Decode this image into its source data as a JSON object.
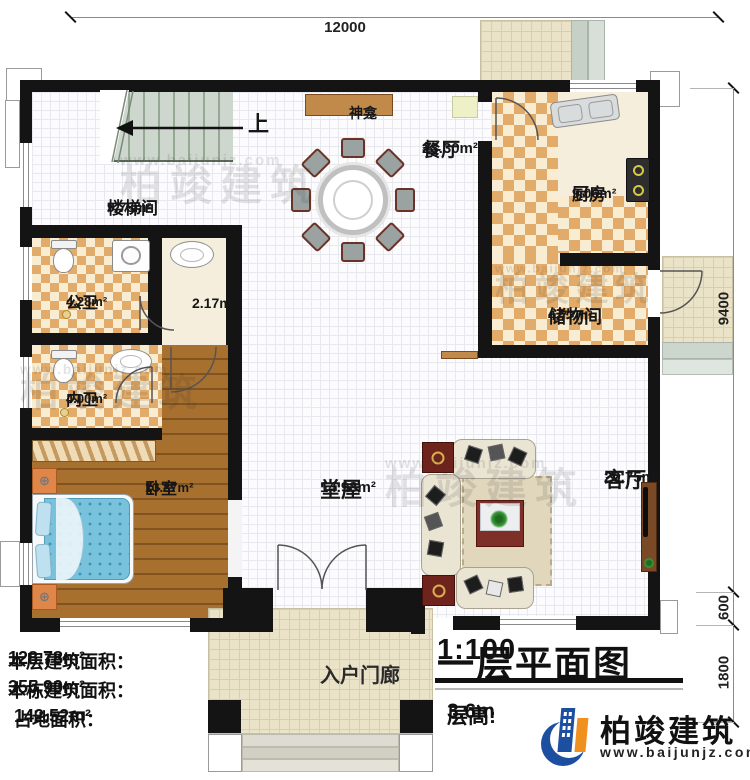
{
  "dimensions": {
    "width_top": "12000",
    "right_main": "9400",
    "right_step": "600",
    "right_porch": "1800"
  },
  "rooms": {
    "stairwell": {
      "name": "楼梯间",
      "area": "9.73m²"
    },
    "dining": {
      "name": "餐厅",
      "area": "23.30m²"
    },
    "kitchen": {
      "name": "厨房",
      "area": "9.06m²"
    },
    "storage": {
      "name": "储物间",
      "area": "4.77m²"
    },
    "public_bath": {
      "name": "公卫",
      "area": "4.28m²"
    },
    "washroom": {
      "area": "2.17m²"
    },
    "inner_bath": {
      "name": "内卫",
      "area": "4.00m²"
    },
    "bedroom": {
      "name": "卧室",
      "area": "13.87m²"
    },
    "hall": {
      "name": "堂屋",
      "area": "14.98m²"
    },
    "living": {
      "name": "客厅",
      "area": "20.75m²"
    },
    "entry_porch": {
      "name": "入户门廊"
    }
  },
  "markers": {
    "shrine": "神龛",
    "stairs_up": "上"
  },
  "stats": {
    "floor_area_label": "本层建筑面积：",
    "floor_area": "128.78m²",
    "building_area_label": "本栋建筑面积：",
    "building_area": "355.90m²",
    "footprint_label": "占地面积：",
    "footprint": "142.52m²"
  },
  "title_block": {
    "title": "一层平面图",
    "scale": "1:100",
    "floor_height_label": "层高:",
    "floor_height": "3.6m"
  },
  "brand": {
    "name": "柏竣建筑",
    "url": "www.baijunjz.com",
    "blue": "#1c4fa0",
    "orange": "#f0901e"
  },
  "watermark": {
    "name": "柏竣建筑",
    "url": "www.baijunjz.com"
  }
}
